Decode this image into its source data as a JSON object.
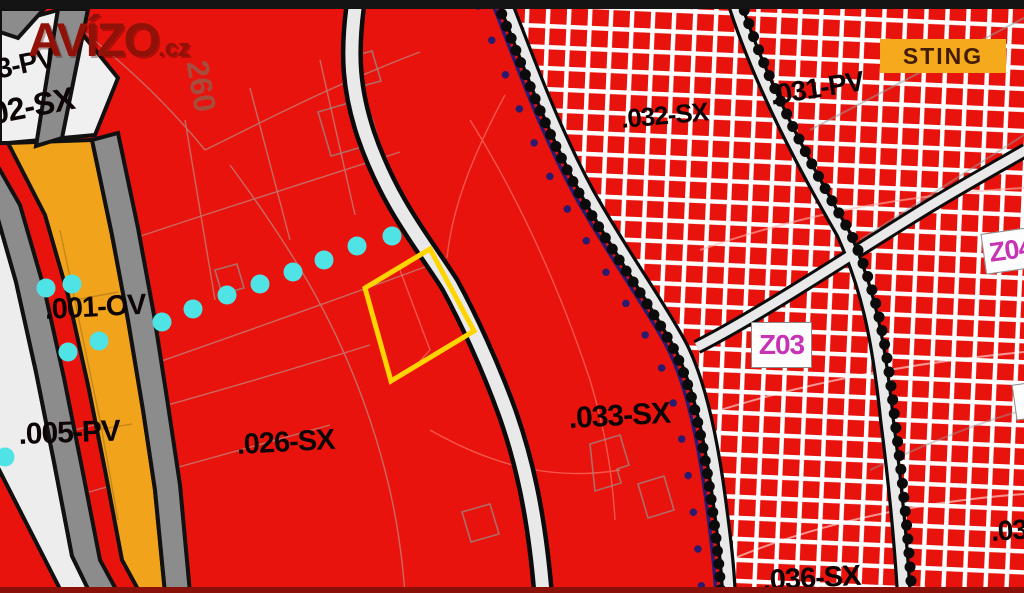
{
  "watermark": {
    "brand": "AVÍZO",
    "tld": ".cz"
  },
  "badges": {
    "sting": "STING",
    "z03": "Z03",
    "z04": "Z04"
  },
  "area_labels": {
    "pv003": "3-PV",
    "sx002": "02-SX",
    "ov001": ".001-OV",
    "pv005": ".005-PV",
    "sx026": ".026-SX",
    "sx033": ".033-SX",
    "sx032": ".032-SX",
    "pv031": ".031-PV",
    "sx036": ".036-SX",
    "sx03x": ".03",
    "plot260": "260"
  },
  "colors": {
    "map_red": "#e9130d",
    "zone_orange": "#f2a31c",
    "road_gray": "#8c8c8c",
    "road_light": "#e9e9e9",
    "hatch_white": "#ffffff",
    "parcel_yellow": "#ffd400",
    "dot_cyan": "#4fe3e6",
    "dot_navy": "#2a1b70",
    "badge_magenta": "#c733b4",
    "sting_bg": "#f5a91c",
    "sting_text": "#421c04",
    "watermark_red": "#8f1107"
  }
}
